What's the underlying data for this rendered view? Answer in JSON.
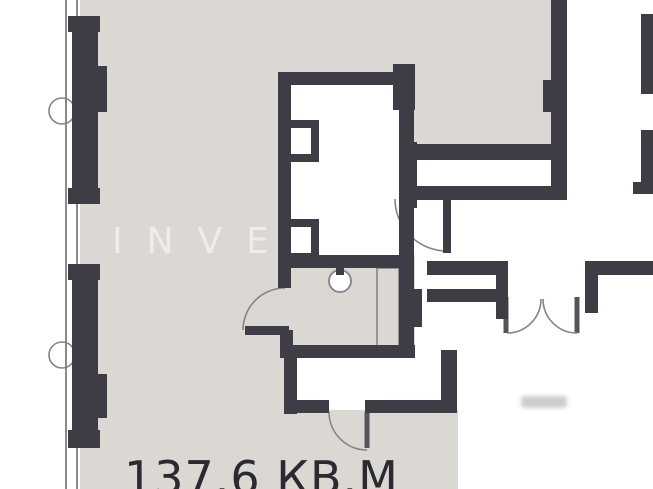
{
  "texts": {
    "area_label": "137.6 КВ.М",
    "watermark": "INVE"
  },
  "colors": {
    "paper": "#ffffff",
    "floor": "#dbd7d2",
    "wall": "#3e3d45",
    "wall_soft": "#55545c",
    "thin_line": "#8b8990",
    "text": "#2b2a30",
    "watermark": "rgba(255,255,255,0.55)"
  },
  "symbols": {
    "doors": [
      "bathroom-door-arc",
      "corridor-door-arc",
      "bottom-room-door-arc",
      "french-double-door"
    ],
    "fixtures": [
      "ceiling-lamp-circle",
      "bathtub-outline",
      "window-wall-left",
      "window-wall-right",
      "column-circle-upper",
      "column-circle-lower"
    ]
  }
}
